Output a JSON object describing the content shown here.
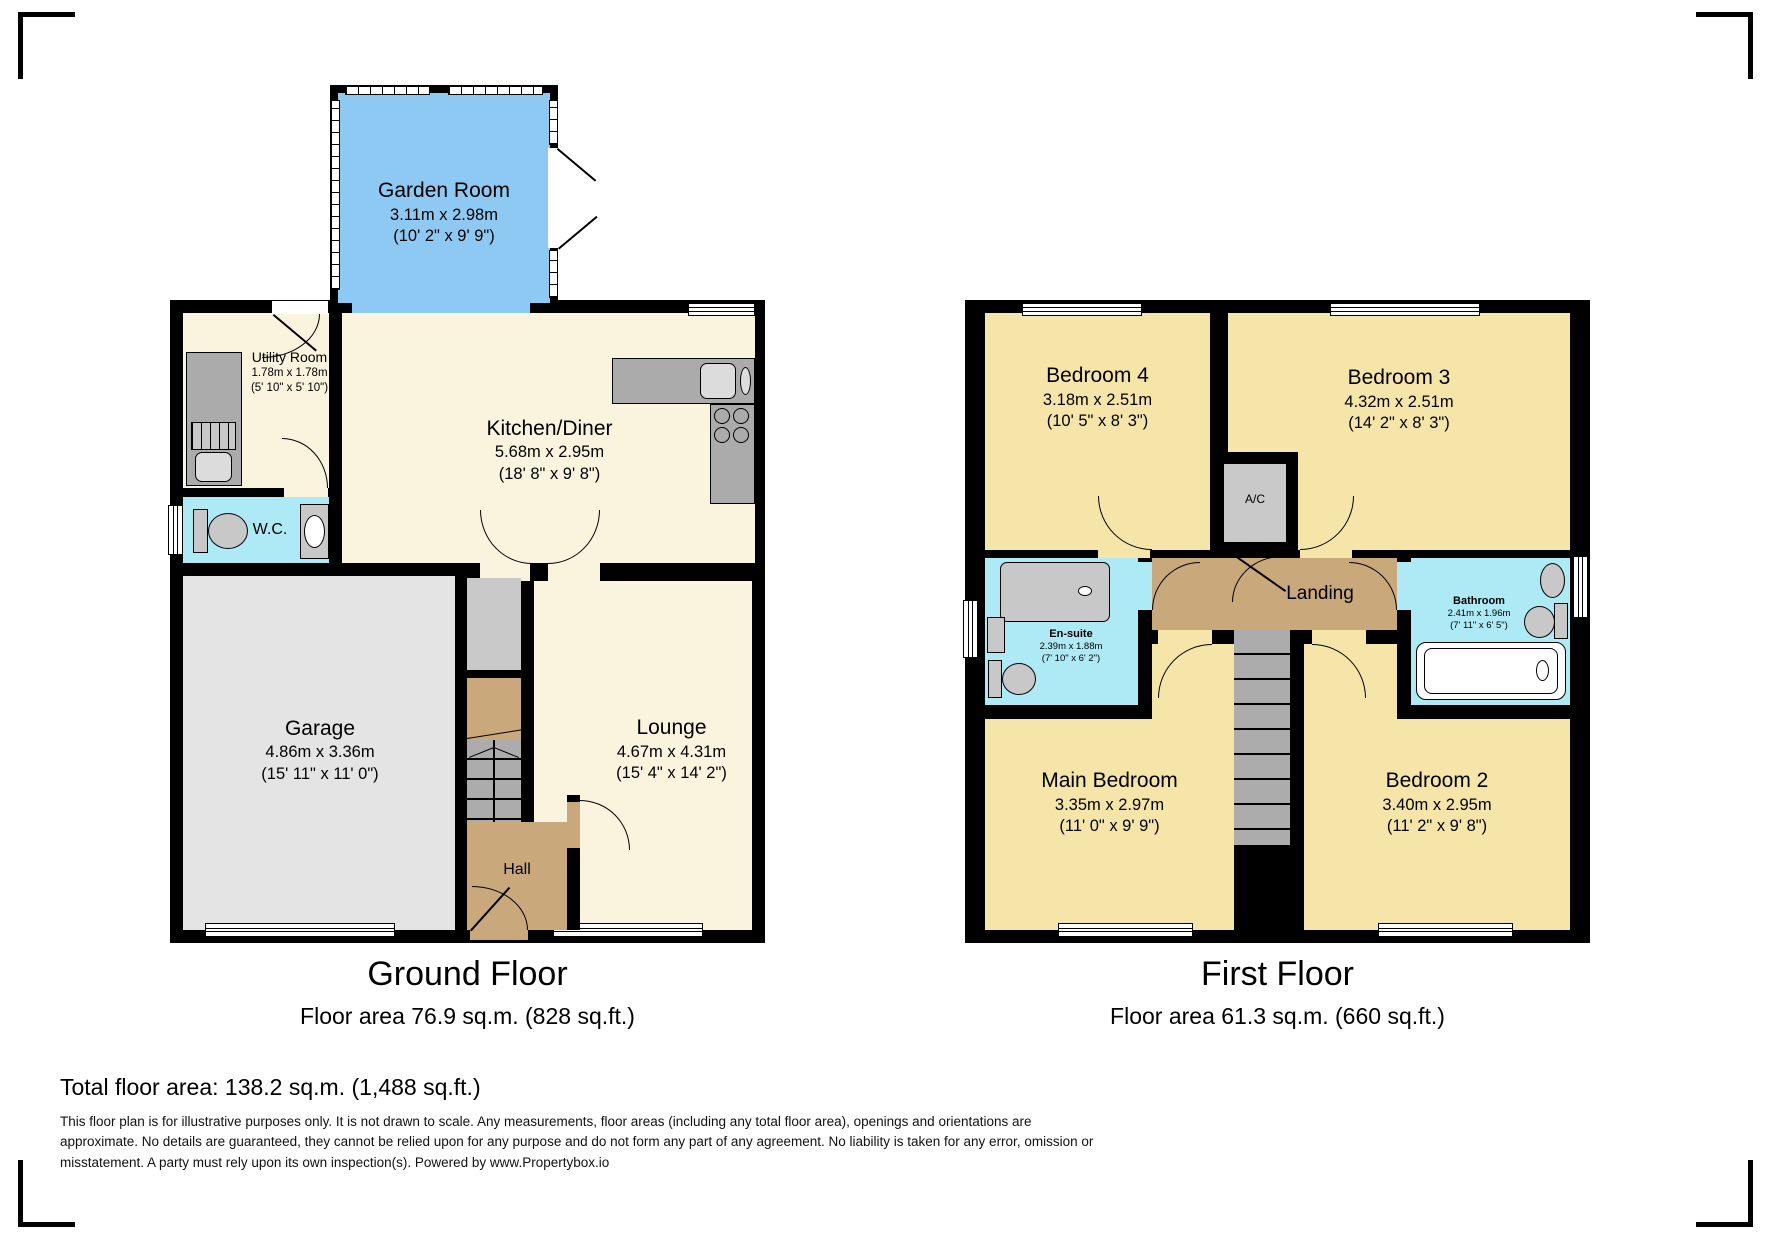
{
  "colors": {
    "wall": "#000000",
    "garden_room_fill": "#8DC9F2",
    "living_fill": "#FAF3DE",
    "bedroom_fill": "#F6E5A9",
    "wet_room_fill": "#AEE9F6",
    "hall_landing_fill": "#C9A87C",
    "garage_fill": "#E4E4E4",
    "counter_fill": "#ABABAB",
    "stairs_fill": "#ACACAC"
  },
  "ground_floor": {
    "title": "Ground Floor",
    "area_label": "Floor area 76.9 sq.m. (828 sq.ft.)",
    "rooms": {
      "garden_room": {
        "name": "Garden Room",
        "metric": "3.11m x 2.98m",
        "imperial": "(10' 2\" x 9' 9\")"
      },
      "utility_room": {
        "name": "Utility Room",
        "metric": "1.78m x 1.78m",
        "imperial": "(5' 10\" x 5' 10\")"
      },
      "kitchen_diner": {
        "name": "Kitchen/Diner",
        "metric": "5.68m x 2.95m",
        "imperial": "(18' 8\" x 9' 8\")"
      },
      "wc": {
        "name": "W.C."
      },
      "garage": {
        "name": "Garage",
        "metric": "4.86m x 3.36m",
        "imperial": "(15' 11\" x 11' 0\")"
      },
      "lounge": {
        "name": "Lounge",
        "metric": "4.67m x 4.31m",
        "imperial": "(15' 4\" x 14' 2\")"
      },
      "hall": {
        "name": "Hall"
      }
    }
  },
  "first_floor": {
    "title": "First Floor",
    "area_label": "Floor area 61.3 sq.m. (660 sq.ft.)",
    "rooms": {
      "bedroom_4": {
        "name": "Bedroom 4",
        "metric": "3.18m x 2.51m",
        "imperial": "(10' 5\" x 8' 3\")"
      },
      "bedroom_3": {
        "name": "Bedroom 3",
        "metric": "4.32m x 2.51m",
        "imperial": "(14' 2\" x 8' 3\")"
      },
      "ac": {
        "name": "A/C"
      },
      "landing": {
        "name": "Landing"
      },
      "en_suite": {
        "name": "En-suite",
        "metric": "2.39m x 1.88m",
        "imperial": "(7' 10\" x 6' 2\")"
      },
      "bathroom": {
        "name": "Bathroom",
        "metric": "2.41m x 1.96m",
        "imperial": "(7' 11\" x 6' 5\")"
      },
      "main_bedroom": {
        "name": "Main Bedroom",
        "metric": "3.35m x 2.97m",
        "imperial": "(11' 0\" x 9' 9\")"
      },
      "bedroom_2": {
        "name": "Bedroom 2",
        "metric": "3.40m x 2.95m",
        "imperial": "(11' 2\" x 9' 8\")"
      }
    }
  },
  "footer": {
    "total_area": "Total floor area: 138.2 sq.m. (1,488 sq.ft.)",
    "disclaimer": "This floor plan is for illustrative purposes only. It is not drawn to scale. Any measurements, floor areas (including any total floor area), openings and orientations are approximate. No details are guaranteed, they cannot be relied upon for any purpose and do not form any part of any agreement. No liability is taken for any error, omission or misstatement. A party must rely upon its own inspection(s). Powered by www.Propertybox.io"
  }
}
